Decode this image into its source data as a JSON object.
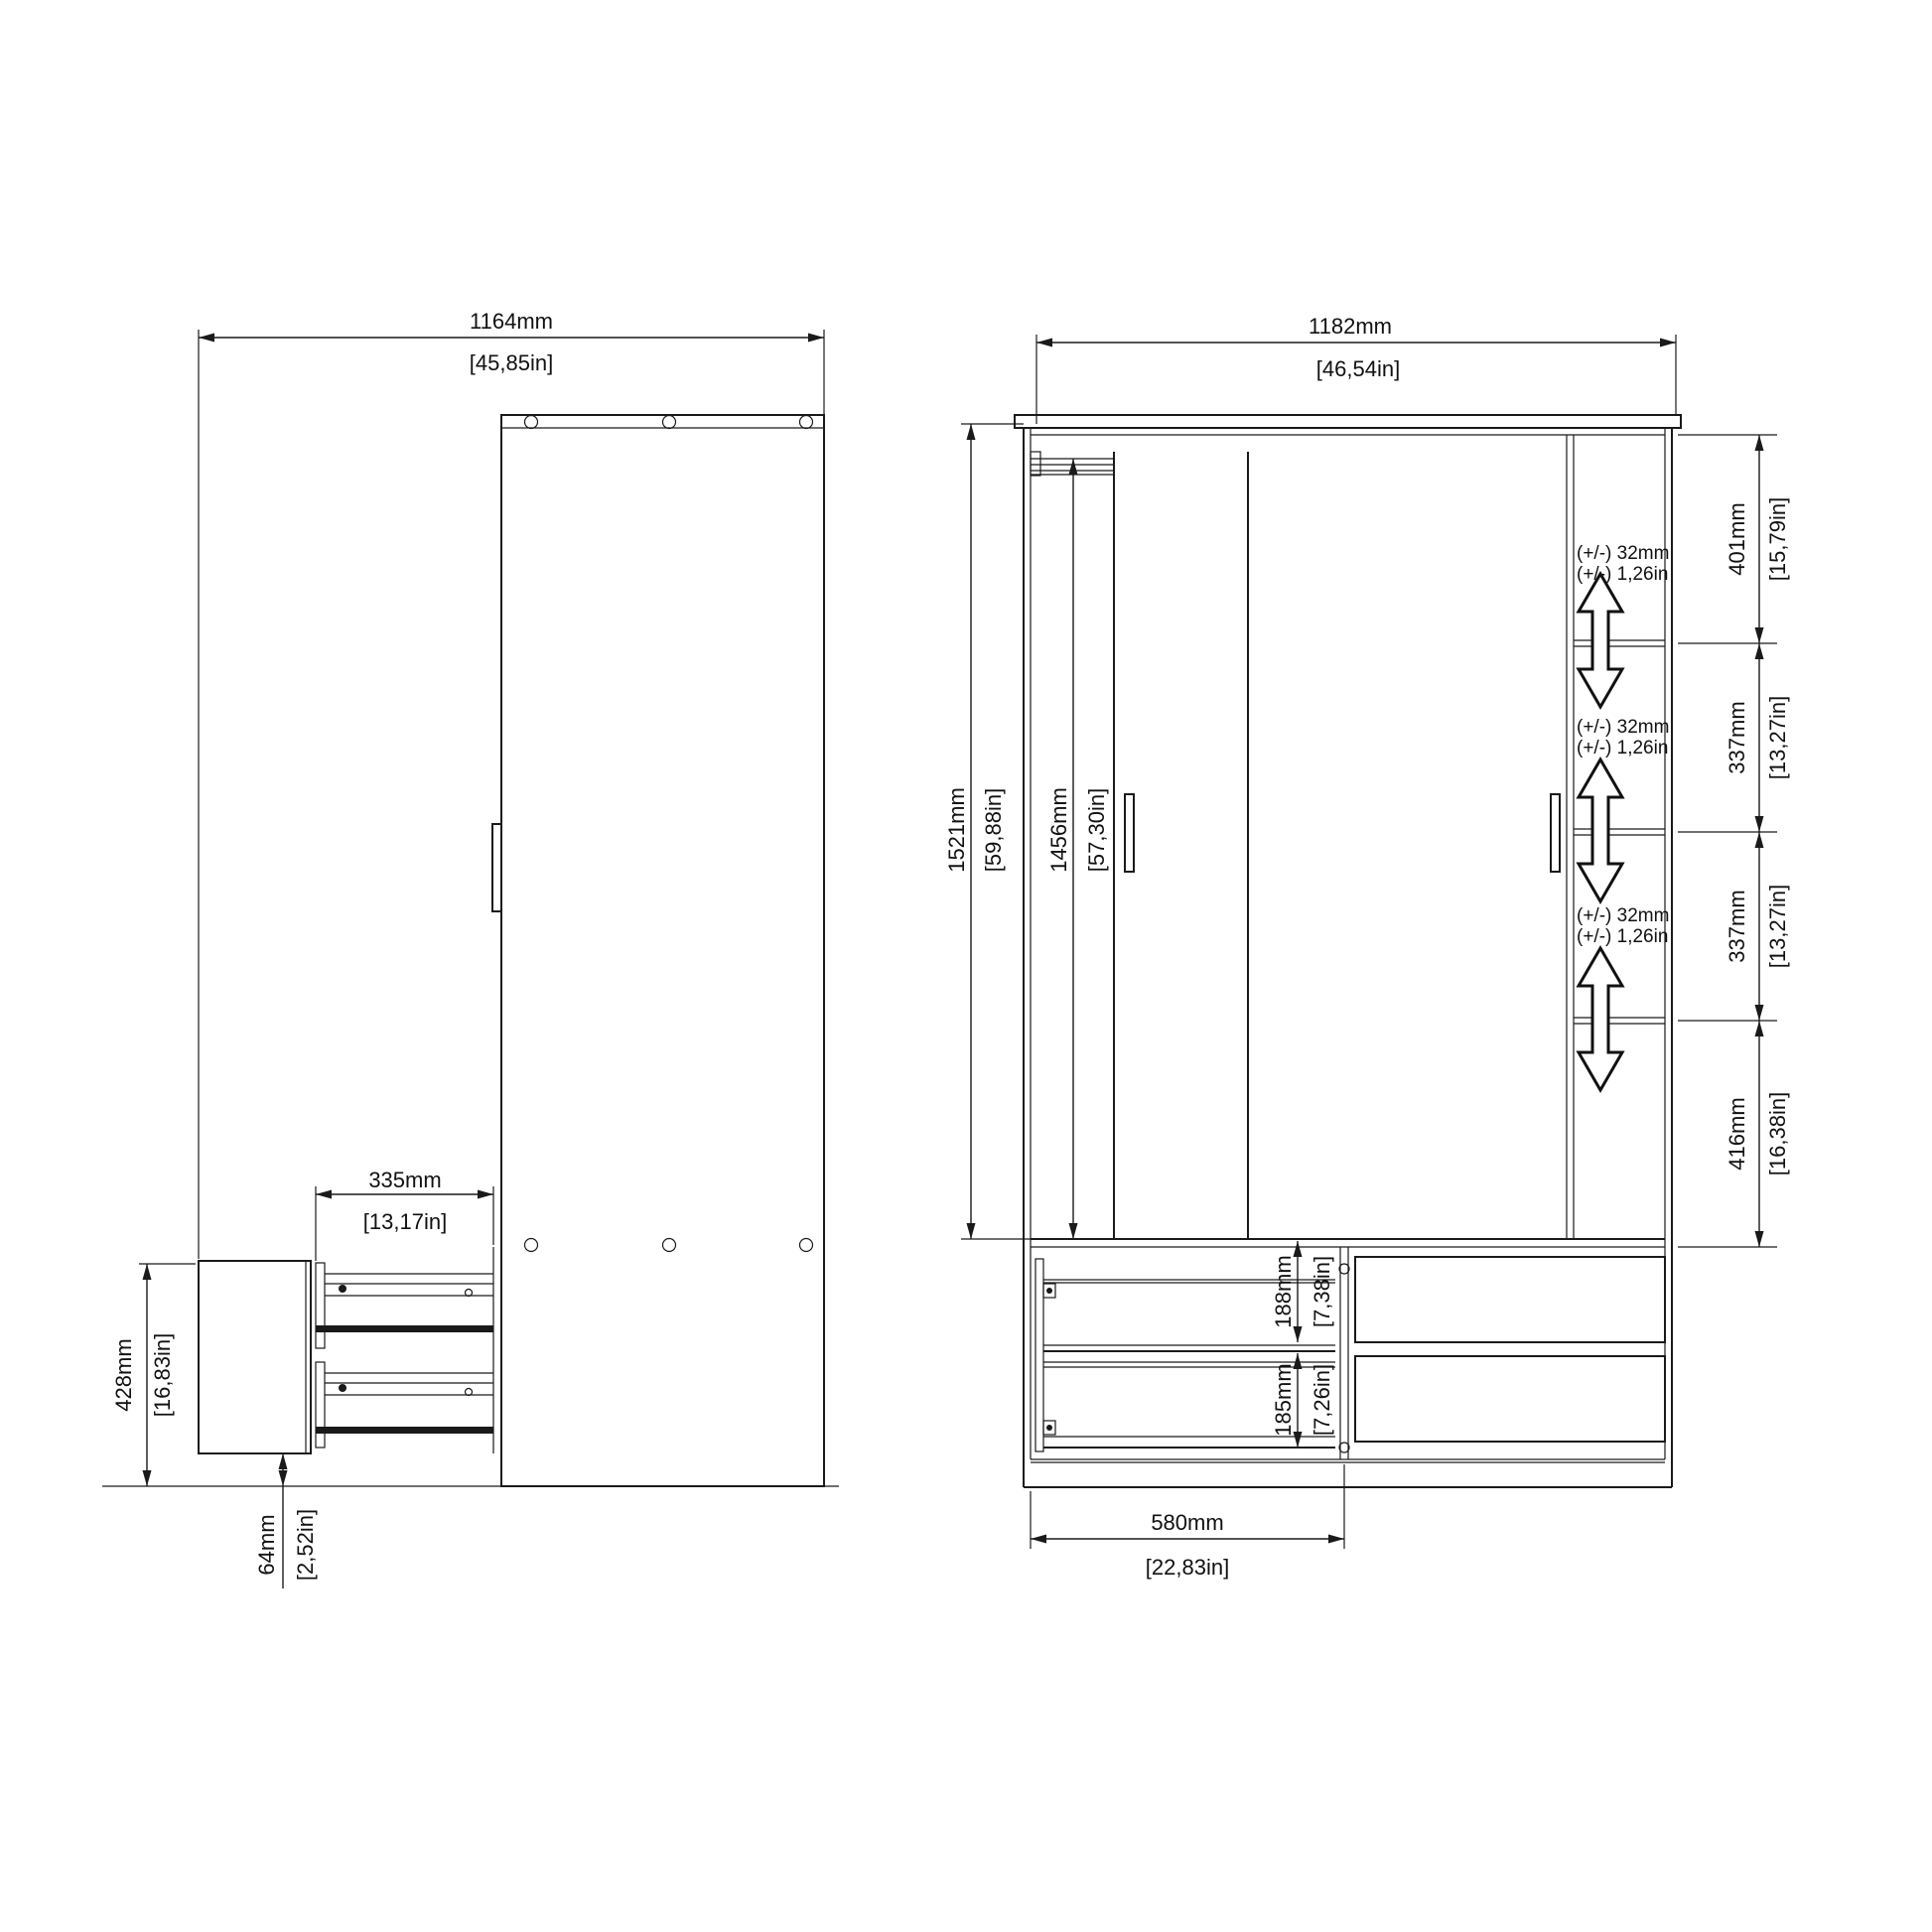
{
  "side_view": {
    "overall_depth_with_drawer_open": {
      "mm": "1164mm",
      "in": "[45,85in]"
    },
    "drawer_extension": {
      "mm": "335mm",
      "in": "[13,17in]"
    },
    "drawer_unit_height": {
      "mm": "428mm",
      "in": "[16,83in]"
    },
    "plinth_clearance": {
      "mm": "64mm",
      "in": "[2,52in]"
    }
  },
  "front_view": {
    "overall_width": {
      "mm": "1182mm",
      "in": "[46,54in]"
    },
    "overall_height": {
      "mm": "1521mm",
      "in": "[59,88in]"
    },
    "door_height": {
      "mm": "1456mm",
      "in": "[57,30in]"
    },
    "shelf_sections": [
      {
        "mm": "401mm",
        "in": "[15,79in]"
      },
      {
        "mm": "337mm",
        "in": "[13,27in]"
      },
      {
        "mm": "337mm",
        "in": "[13,27in]"
      },
      {
        "mm": "416mm",
        "in": "[16,38in]"
      }
    ],
    "shelf_adjust_notes": [
      {
        "line1": "(+/-) 32mm",
        "line2": "(+/-) 1,26in"
      },
      {
        "line1": "(+/-) 32mm",
        "line2": "(+/-) 1,26in"
      },
      {
        "line1": "(+/-) 32mm",
        "line2": "(+/-) 1,26in"
      }
    ],
    "drawer_front_heights": {
      "top": {
        "mm": "188mm",
        "in": "[7,38in]"
      },
      "bottom": {
        "mm": "185mm",
        "in": "[7,26in]"
      }
    },
    "drawer_compartment_width": {
      "mm": "580mm",
      "in": "[22,83in]"
    }
  },
  "colors": {
    "line": "#1a1a1a",
    "background": "#ffffff"
  }
}
